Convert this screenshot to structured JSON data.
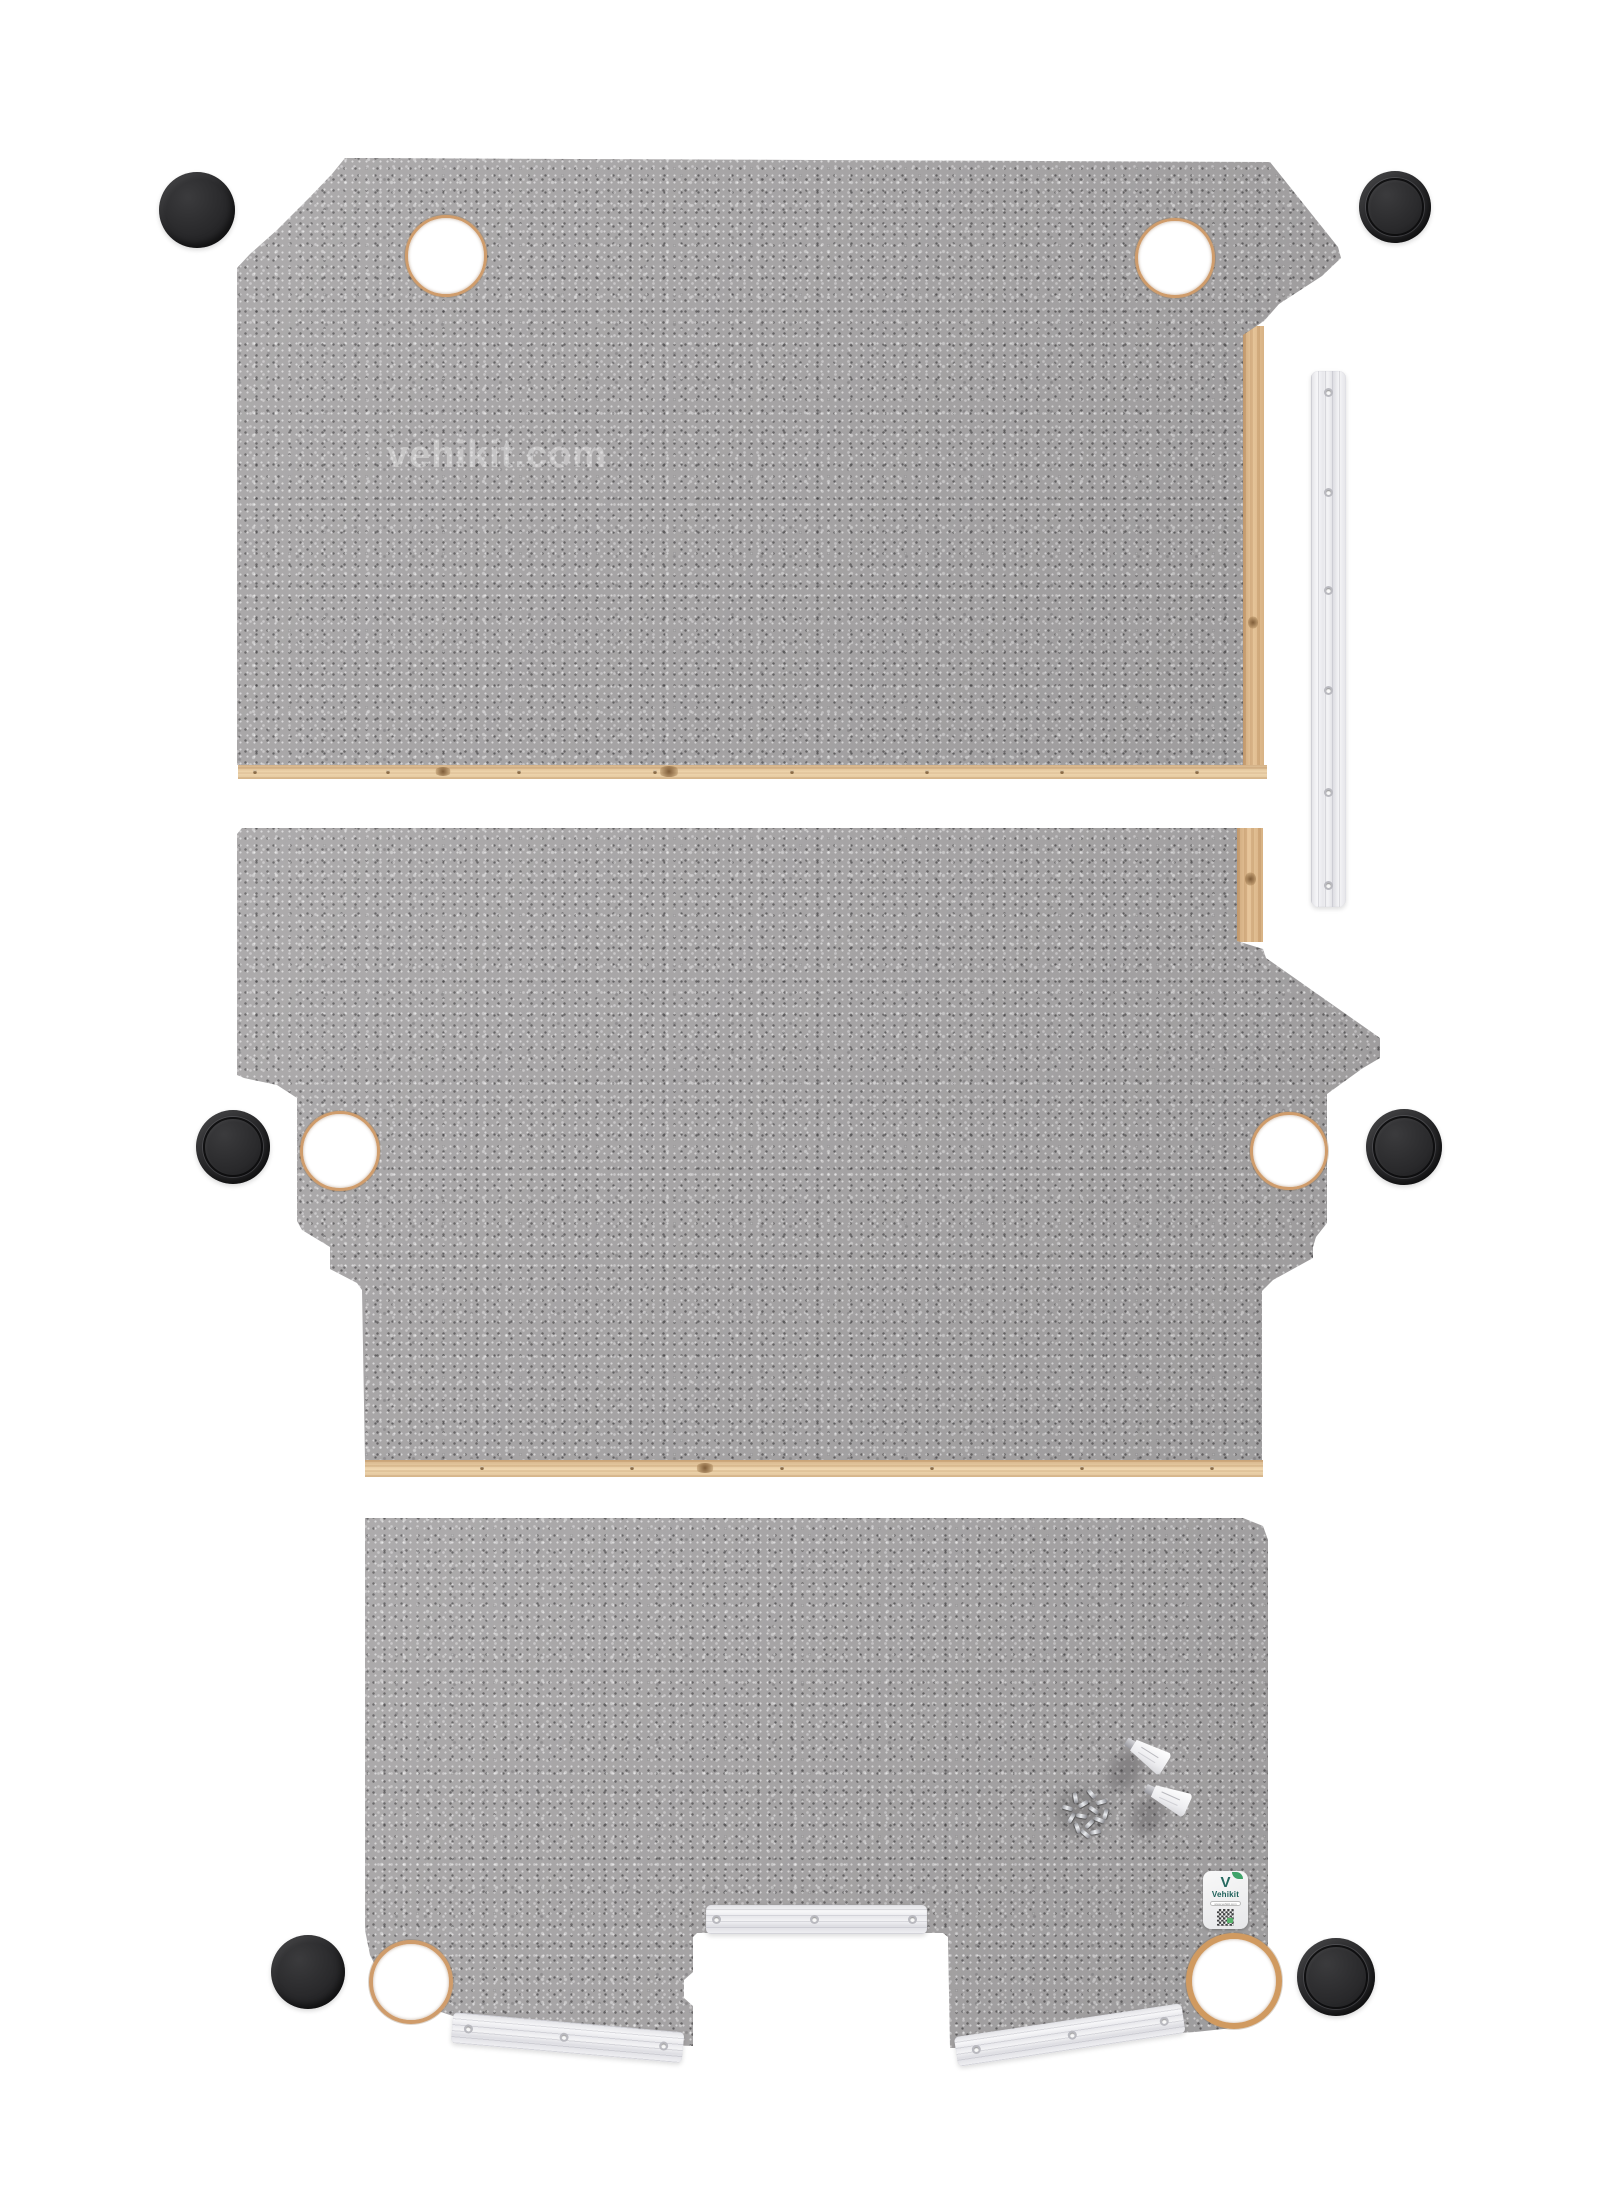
{
  "watermark": {
    "text": "vehikit.com"
  },
  "sticker": {
    "brand": "Vehikit",
    "url": "www.vehikit.com"
  },
  "colors": {
    "background": "#ffffff",
    "panel_gray_base": "#a7a5a6",
    "speckle_dark": "#3a383a",
    "speckle_light": "#e2e0e1",
    "plywood_edge": "#d5ab7c",
    "plywood_bottom_edge": "#eed4ac",
    "hole_rim": "#cf9c6b",
    "blanking_cap": "#2b2b2d",
    "aluminium_trim": "#ececef",
    "brand_teal": "#1c5f58",
    "brand_green": "#3fa369",
    "screw_silver": "#c6c7cb"
  }
}
